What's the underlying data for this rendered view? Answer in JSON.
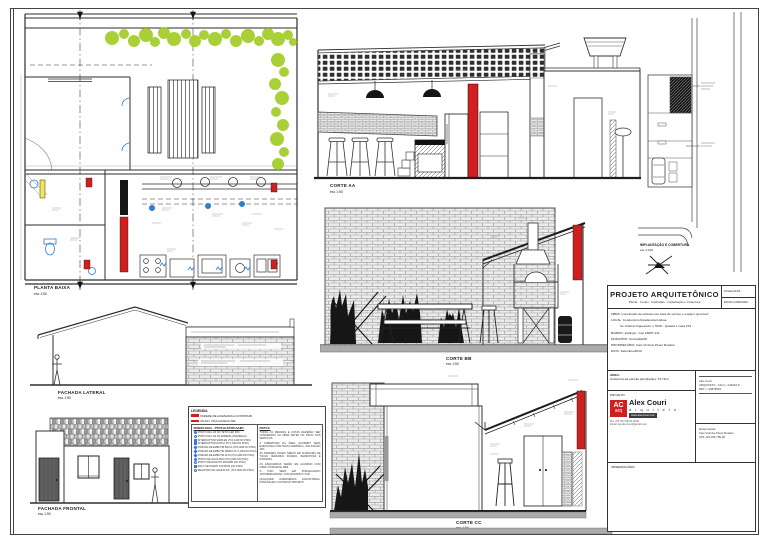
{
  "colors": {
    "accent_red": "#cf1f1f",
    "vegetation_green": "#a2ce27",
    "plumbing_blue": "#2f7cd6",
    "highlight_yellow": "#f2e84e"
  },
  "panels": {
    "planta_baixa": {
      "label": "PLANTA BAIXA",
      "scale": "esc 1:50"
    },
    "corte_aa": {
      "label": "CORTE AA",
      "scale": "esc 1:50"
    },
    "corte_bb": {
      "label": "CORTE BB",
      "scale": "esc 1:50"
    },
    "corte_cc": {
      "label": "CORTE CC",
      "scale": "esc 1:50"
    },
    "fachada_lateral": {
      "label": "FACHADA LATERAL",
      "scale": "esc 1:50"
    },
    "fachada_frontal": {
      "label": "FACHADA FRONTAL",
      "scale": "esc 1:50"
    },
    "implantacao": {
      "label": "IMPLANTAÇÃO E COBERTURA",
      "scale": "esc 1:100"
    }
  },
  "legend": {
    "title": "LEGENDA",
    "items": [
      {
        "label": "PAREDE DE ALVENARIA A CONSTRUIR"
      },
      {
        "label": "PILAR / VIGA A EXECUTAR"
      }
    ],
    "simbologia_title": "SIMBOLOGIA - PTOS ELÉTRICA/HID.",
    "simbologia": [
      "PONTO DE LUZ NO TETO (LED 9W)",
      "PONTO DE LUZ NA PAREDE (ARANDELA)",
      "INTERRUPTOR SIMPLES (H=1,10M DO PISO)",
      "INTERRUPTOR DUPLO (H=1,10M DO PISO)",
      "TOMADA DE EMBUTIR BAIXA (H=0,30M DO PISO)",
      "TOMADA DE EMBUTIR MÉDIA (H=1,10M DO PISO)",
      "TOMADA DE EMBUTIR ALTA (H=2,00M DO PISO)",
      "PONTO DE ÁGUA FRIA (H=0,60M DO PISO)",
      "PONTO DE ESGOTO Ø100MM (NO PISO)",
      "RALO SIFONADO 15X15CM (NO PISO)",
      "REGISTRO DE GAVETA 3/4\" (H=1,80M DO PISO)"
    ],
    "notas_title": "NOTAS:",
    "notas": [
      "TODAS AS MEDIDAS E COTAS DEVERÃO SER CONFERIDAS NA OBRA ANTES DO INÍCIO DOS SERVIÇOS.",
      "A COBERTURA DA ÁREA GOURMET SERÁ EXECUTADA COM TELHA CERÂMICA, INCLINAÇÃO 30%.",
      "AS PAREDES NOVAS SERÃO EM ALVENARIA DE TIJOLO CERÂMICO FURADO, REVESTIDAS E PINTADAS.",
      "AS ESQUADRIAS SERÃO EM ALUMÍNIO COM VIDRO COMUM DE 4MM.",
      "O PISO SERÁ EM PORCELANATO ANTIDERRAPANTE, COM RODAPÉ H=7CM.",
      "QUALQUER DIVERGÊNCIA ENCONTRADA, COMUNICAR O AUTOR DO PROJETO."
    ]
  },
  "titleblock": {
    "title": "PROJETO ARQUITETÔNICO",
    "subtitle": "Planta - Cortes - Fachadas - Implantação e Cobertura",
    "folha": "FOLHA 01/02",
    "escala": "ESCALA INDICADA",
    "obra": "OBRA: Construção de edícula com área de serviço e espaço \"gourmet\"",
    "local_1": "LOCAL: Condomínio Residencial Lisboa",
    "local_2": "Av. Antônio Figueiredo n. 5100 - Quadra 1 casa 234",
    "bairro": "BAIRRO: Ipatinga - Cep 18087-131",
    "municipio": "MUNICÍPIO: Sorocaba/SP",
    "proprietario": "PROPRIETÁRIO: Caio Vinícius Pérez Rosário",
    "data": "DATA: Setembro/2019",
    "area_title": "ÁREA:",
    "area_value": "Cobertura da edícula (ampliação): 76,73m²",
    "projeto_title": "PROJETO:",
    "logo": {
      "ac": "AC",
      "arq": "arq",
      "name": "Alex Couri",
      "profession": "a r q u i t e t o",
      "site": "www.alexcouri.com"
    },
    "contact_tel": "Tel: +55 (15) 99711-0000",
    "contact_email": "Email: ale.alexcouri@gmail.com",
    "arch_line1": "Alex Couri",
    "arch_line2": "ARQUITETO - CAU n. A43210-5",
    "arch_line3": "RRT n. 00876543",
    "resp_title": "Responsável:",
    "resp_name": "Caio Vinícius Pérez Rosário",
    "resp_doc": "CPF 123.456.789-00",
    "obs_title": "OBSERVAÇÕES:"
  }
}
